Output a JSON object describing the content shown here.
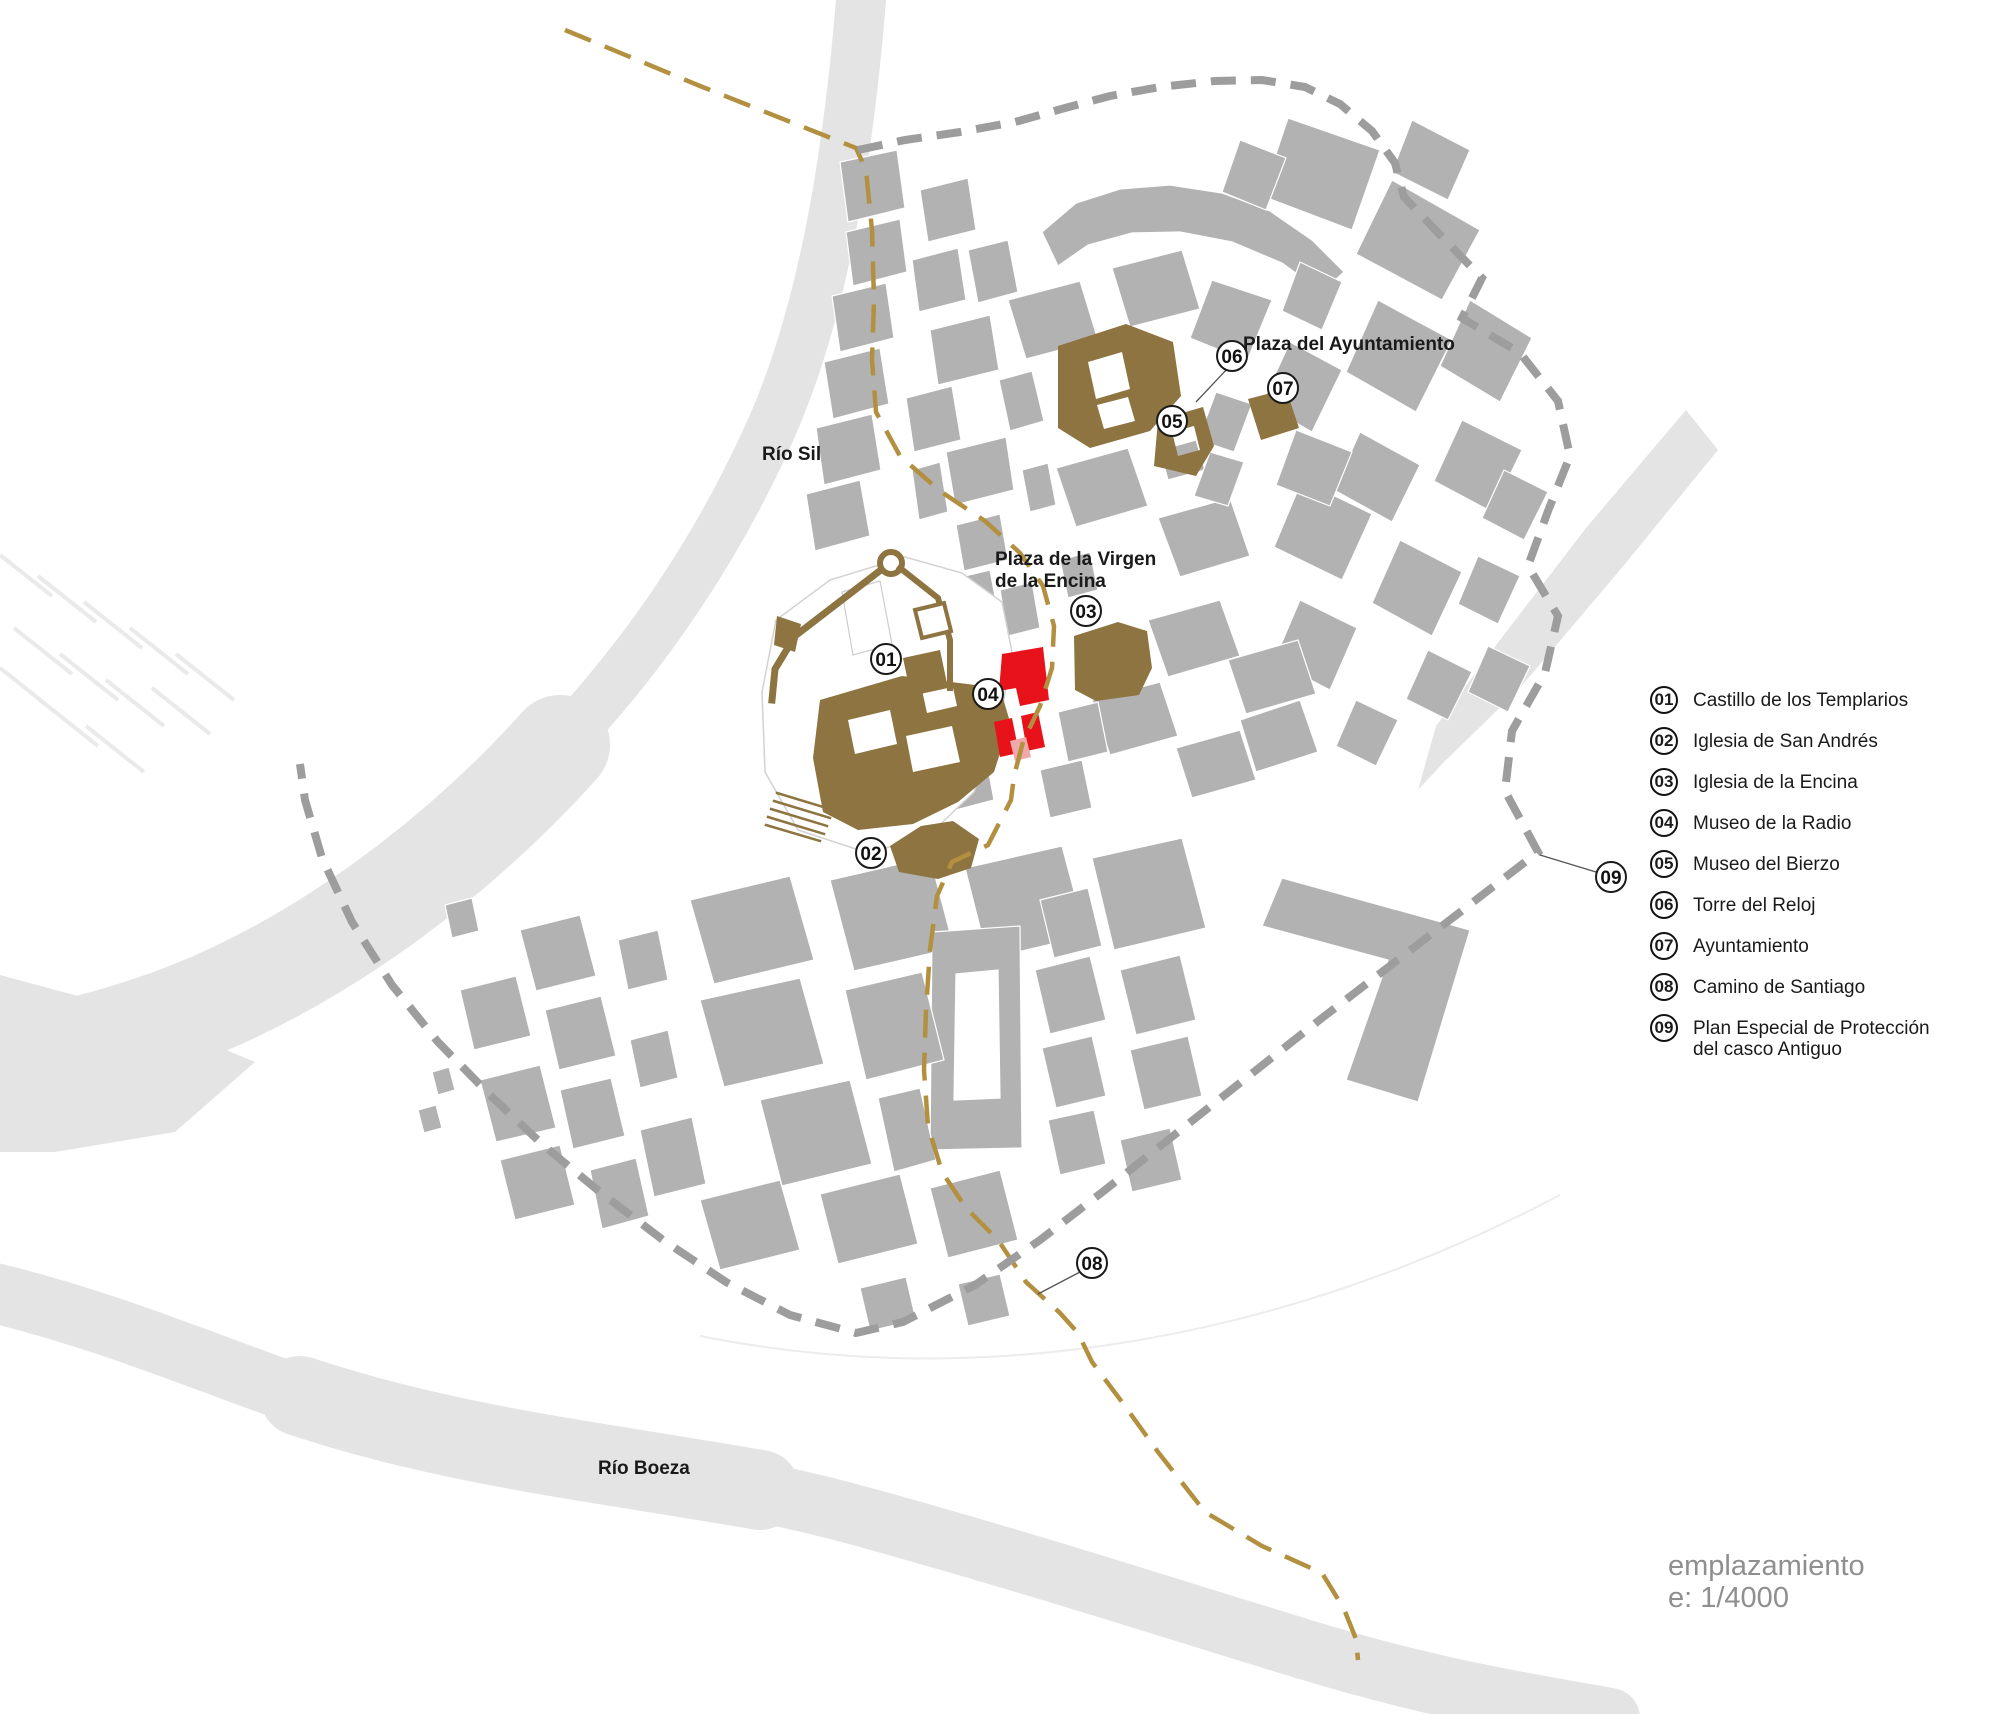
{
  "map": {
    "labels": {
      "rio_sil": "Río Sil",
      "rio_boeza": "Río Boeza",
      "plaza_ayuntamiento": "Plaza del Ayuntamiento",
      "plaza_virgen_line1": "Plaza de la Virgen",
      "plaza_virgen_line2": "de la Encina"
    },
    "marker_numbers": [
      "01",
      "02",
      "03",
      "04",
      "05",
      "06",
      "07",
      "08",
      "09"
    ]
  },
  "legend": {
    "items": [
      {
        "num": "01",
        "label": "Castillo de los Templarios"
      },
      {
        "num": "02",
        "label": "Iglesia de San Andrés"
      },
      {
        "num": "03",
        "label": "Iglesia de la Encina"
      },
      {
        "num": "04",
        "label": "Museo de la Radio"
      },
      {
        "num": "05",
        "label": "Museo del Bierzo"
      },
      {
        "num": "06",
        "label": "Torre del Reloj"
      },
      {
        "num": "07",
        "label": "Ayuntamiento"
      },
      {
        "num": "08",
        "label": "Camino de Santiago"
      },
      {
        "num": "09",
        "label": "Plan Especial de Protección",
        "label2": "del casco Antiguo"
      }
    ]
  },
  "scale_block": {
    "name": "emplazamiento",
    "scale": "e: 1/4000"
  },
  "colors": {
    "building": "#b2b2b2",
    "river": "#e4e4e4",
    "landmark_brown": "#8d7440",
    "highlight_red": "#e8121a",
    "highlight_pink": "#f0a8a8",
    "boundary_grey": "#9d9d9d",
    "camino_gold": "#b2903f",
    "text": "#1a1a1a",
    "muted_text": "#8f8f8f"
  }
}
